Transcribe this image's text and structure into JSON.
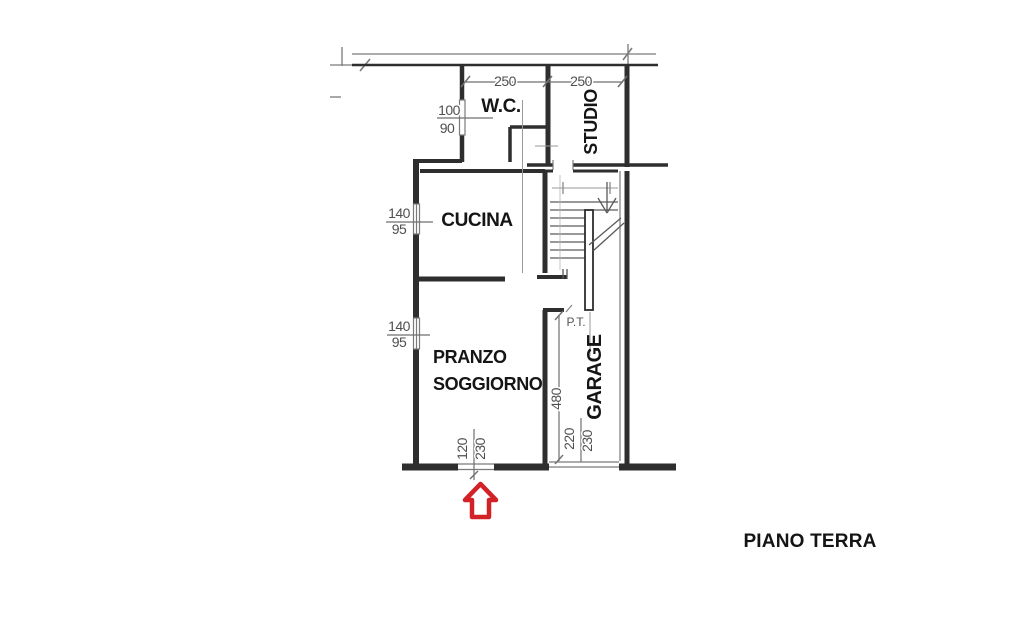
{
  "title": "PIANO TERRA",
  "rooms": {
    "wc": "W.C.",
    "studio": "STUDIO",
    "cucina": "CUCINA",
    "pranzo_line1": "PRANZO",
    "pranzo_line2": "SOGGIORNO",
    "garage": "GARAGE",
    "stairs_level": "P.T."
  },
  "dimensions": {
    "wc_width": "250",
    "studio_width": "250",
    "wc_window_w": "100",
    "wc_window_h": "90",
    "cucina_window_w": "140",
    "cucina_window_h": "95",
    "pranzo_window_w": "140",
    "pranzo_window_h": "95",
    "entrance_door_w": "120",
    "entrance_door_h": "230",
    "garage_depth": "480",
    "garage_door_w": "220",
    "garage_door_h": "230"
  },
  "colors": {
    "wall": "#2e2e2e",
    "thin_line": "#7a7a7a",
    "dim_text": "#4f4f4f",
    "room_text": "#151515",
    "arrow_red": "#d22228"
  }
}
